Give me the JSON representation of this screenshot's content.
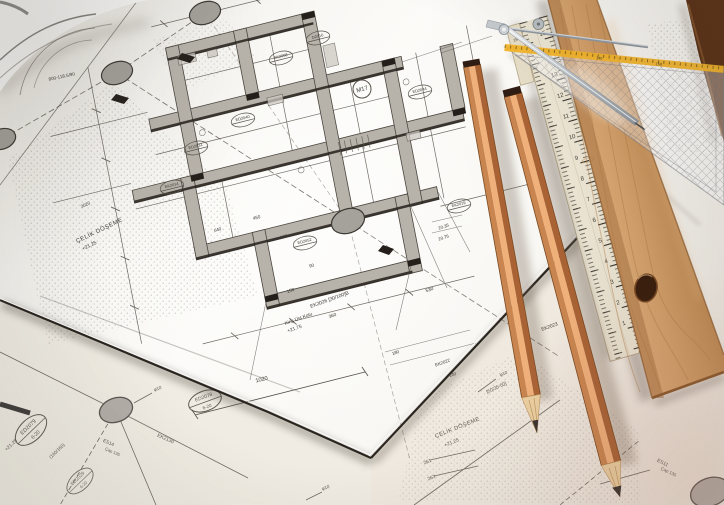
{
  "scene": {
    "type": "photograph",
    "subject": "Structural blueprint sheet with two wooden pencils, wooden ruler, folding rule, set square and metal divider"
  },
  "plan": {
    "labels": [
      "M17",
      "800-118.5/90",
      "ÇELİK DÖŞEME",
      "+21.25",
      "Kiriş Üst Kotu",
      "+21.75",
      "EK2026 [30/100]B",
      "530",
      "360",
      "150",
      "1020",
      "EK2130",
      "ES14",
      "Çap 135",
      "ED2079",
      "6-20",
      "ED2078",
      "6-20",
      "φ10",
      "φ10",
      "φ10",
      "(160/160)",
      "+21.25",
      "ÇELİK DÖŞEME",
      "+21.25",
      "261",
      "263",
      "[50/35-50]",
      "ES11",
      "Çap 135",
      "EK2023",
      "20.35",
      "20.75",
      "180",
      "EK2022",
      "140",
      "450",
      "90",
      "160",
      "640",
      "3020",
      "ED2029",
      "6-20"
    ],
    "micro_stamps": [
      "ED2031",
      "EK2014",
      "ED2040",
      "EK2008",
      "D2016",
      "ED2044",
      "EK2019",
      "ED2052"
    ]
  },
  "tools": {
    "folding_ruler": {
      "numbers": [
        "20",
        "19",
        "15",
        "14",
        "13",
        "12",
        "11",
        "10",
        "9",
        "8",
        "7",
        "6",
        "5",
        "4",
        "3",
        "2",
        "1"
      ]
    },
    "set_square": {
      "scale": [
        "140",
        "150"
      ]
    }
  },
  "colors": {
    "paper": "#f7f5f0",
    "under_paper": "#f0ece3",
    "ink": "#565048",
    "ink_dark": "#241f1a",
    "wall_gray": "#b7b2aa",
    "pencil_wood": "#d8935d",
    "pencil_highlight": "#f0b07a",
    "pencil_dark": "#a86234",
    "graphite": "#37332f",
    "plank_wood": "#d5a26c",
    "plank_dark": "#5a3115",
    "folding_ruler": "#eae3d1",
    "yellow": "#f2b32a",
    "metal": "#c8cdd1"
  }
}
